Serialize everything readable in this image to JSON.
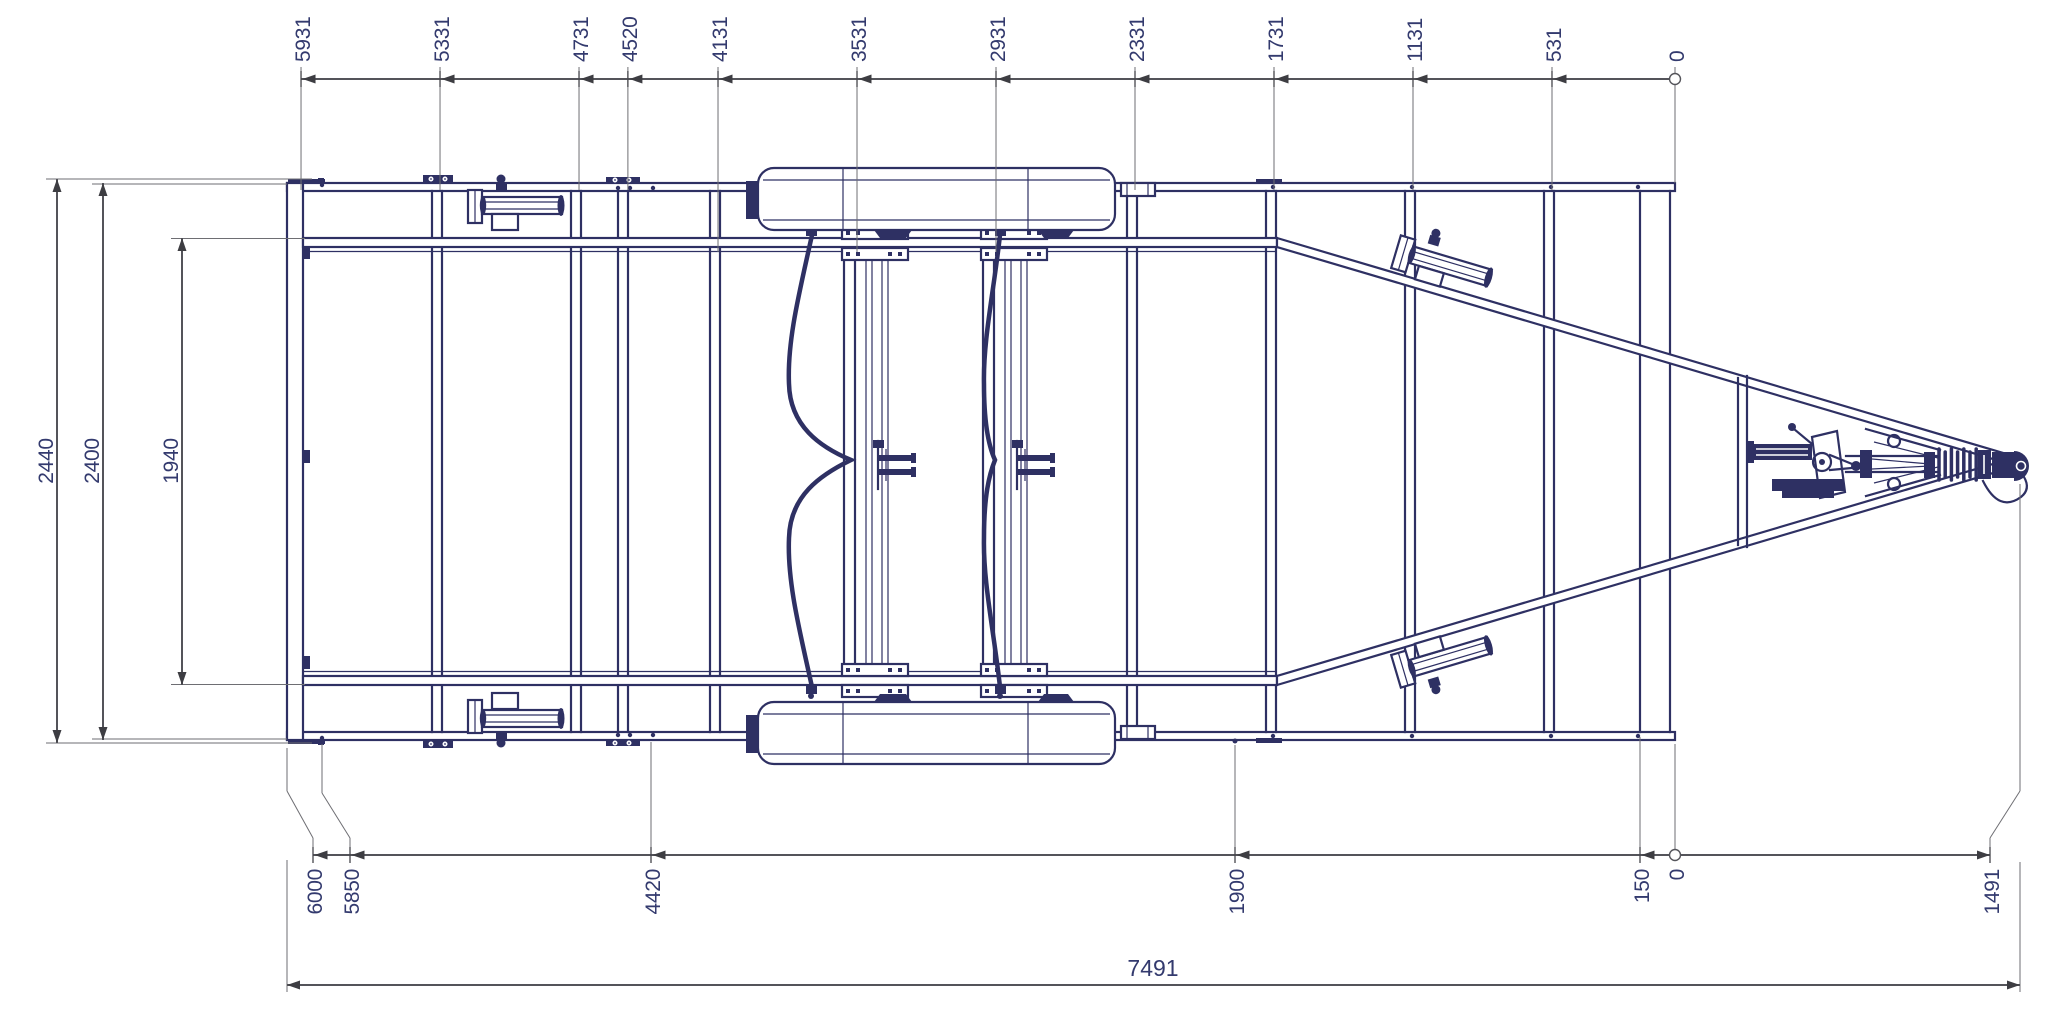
{
  "drawing": {
    "kind": "technical-cad-top-view",
    "subject": "boat trailer frame plan view",
    "background_color": "#ffffff",
    "line_color": "#2e3063",
    "dim_line_color": "#54545a",
    "dim_text_color": "#333a6e",
    "top_chain_labels": [
      "5931",
      "5331",
      "4731",
      "4520",
      "4131",
      "3531",
      "2931",
      "2331",
      "1731",
      "1131",
      "531",
      "0"
    ],
    "bottom_chain_labels": [
      "6000",
      "5850",
      "4420",
      "1900",
      "150",
      "0",
      "1491"
    ],
    "width_labels": [
      "2440",
      "2400",
      "1940"
    ],
    "overall_length_label": "7491"
  }
}
